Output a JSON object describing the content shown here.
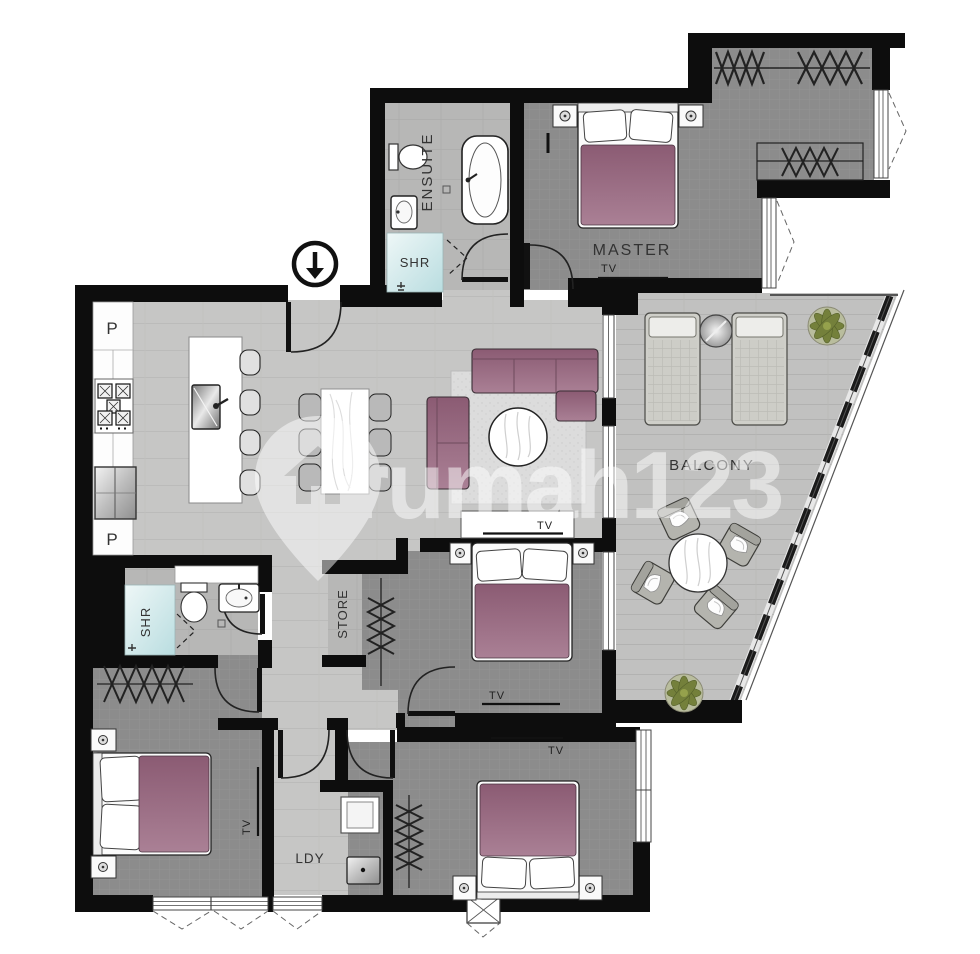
{
  "plan": {
    "type": "apartment-floor-plan",
    "watermark": {
      "text": "rumah123",
      "logo": "rumah123-house-pin"
    },
    "labels": {
      "master": "MASTER",
      "ensuite": "ENSUITE",
      "shr_ensuite": "SHR",
      "shr_bath2": "SHR",
      "balcony": "BALCONY",
      "store": "STORE",
      "laundry": "LDY",
      "pantry_top": "P",
      "pantry_bottom": "P",
      "tv_master": "TV",
      "tv_living": "TV",
      "tv_bedroom2": "TV",
      "tv_bedroom3": "TV",
      "tv_bedroom4": "TV"
    },
    "colors": {
      "wall": "#0d0d0d",
      "floor_light": "#c6c6c5",
      "floor_mid": "#b5b5b4",
      "floor_dark": "#8c8c8c",
      "floor_balcony": "#c1c1c0",
      "bed_accent": "#96647c",
      "shower": "#cfe7e8",
      "plant": "#74803b",
      "watermark": "#ffffff"
    }
  }
}
